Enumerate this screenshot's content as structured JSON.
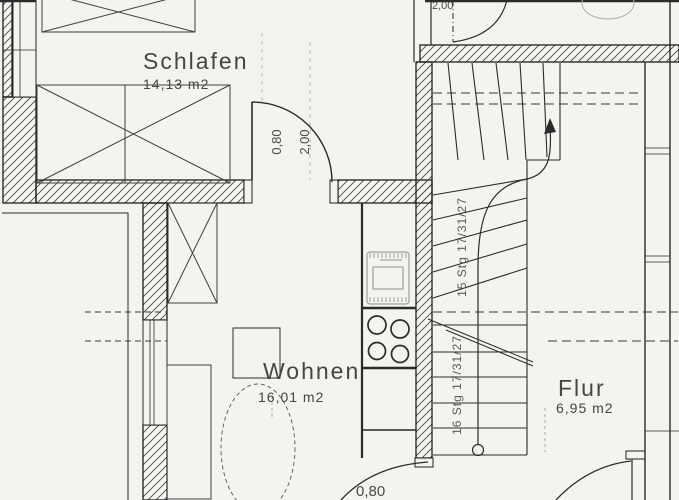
{
  "plan": {
    "rooms": [
      {
        "name": "Schlafen",
        "area": "14,13 m2"
      },
      {
        "name": "Wohnen",
        "area": "16,01 m2"
      },
      {
        "name": "Flur",
        "area": "6,95 m2"
      }
    ],
    "stairs": {
      "upper_label": "15 Stg 17/31/27",
      "lower_label": "16 Stg 17/31/27"
    },
    "dims": {
      "schlafen_door_width": "0,80",
      "schlafen_door_height": "2,00",
      "wohnen_door_width": "0,80",
      "top_door_height": "2,00"
    },
    "colors": {
      "paper": "#f4f3ef",
      "ink": "#2b2b2b",
      "faint": "#9a9a9a"
    }
  }
}
